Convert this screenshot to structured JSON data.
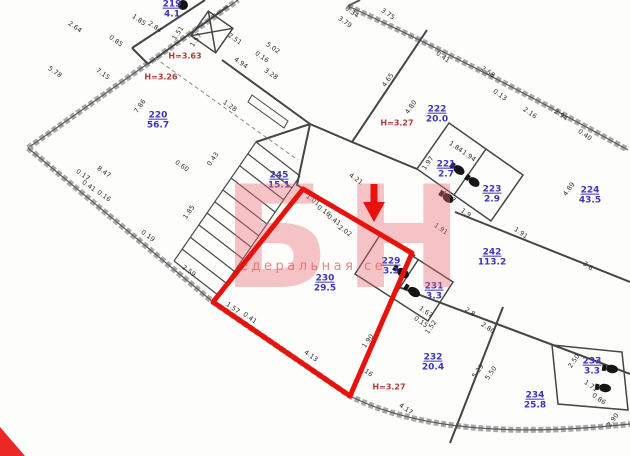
{
  "watermark": {
    "big": "БН",
    "small": "едеральная се"
  },
  "highlight_color": "#e8120c",
  "rooms": [
    {
      "num": "219",
      "area": "4.1",
      "x": 172,
      "y": 10
    },
    {
      "num": "220",
      "area": "56.7",
      "x": 158,
      "y": 121
    },
    {
      "num": "222",
      "area": "20.0",
      "x": 437,
      "y": 115
    },
    {
      "num": "221",
      "area": "2.7",
      "x": 446,
      "y": 170
    },
    {
      "num": "223",
      "area": "2.9",
      "x": 492,
      "y": 195
    },
    {
      "num": "224",
      "area": "43.5",
      "x": 590,
      "y": 196
    },
    {
      "num": "242",
      "area": "113.2",
      "x": 492,
      "y": 258
    },
    {
      "num": "245",
      "area": "15.1",
      "x": 279,
      "y": 181
    },
    {
      "num": "230",
      "area": "29.5",
      "x": 325,
      "y": 284
    },
    {
      "num": "229",
      "area": "3.3",
      "x": 391,
      "y": 267
    },
    {
      "num": "231",
      "area": "3.3",
      "x": 434,
      "y": 292
    },
    {
      "num": "232",
      "area": "20.4",
      "x": 433,
      "y": 363
    },
    {
      "num": "233",
      "area": "3.3",
      "x": 592,
      "y": 367
    },
    {
      "num": "234",
      "area": "25.8",
      "x": 535,
      "y": 401
    }
  ],
  "heights": [
    {
      "t": "Н=3.63",
      "x": 185,
      "y": 56
    },
    {
      "t": "Н=3.26",
      "x": 161,
      "y": 77
    },
    {
      "t": "Н=3.27",
      "x": 397,
      "y": 123
    },
    {
      "t": "Н=3.27",
      "x": 389,
      "y": 387
    }
  ],
  "dimensions": [
    {
      "t": "2.64",
      "x": 75,
      "y": 27,
      "r": 35
    },
    {
      "t": "1.85",
      "x": 139,
      "y": 20,
      "r": 35
    },
    {
      "t": "2.84",
      "x": 155,
      "y": 27,
      "r": 35
    },
    {
      "t": "1.51",
      "x": 178,
      "y": 33,
      "r": -55
    },
    {
      "t": "1.57",
      "x": 196,
      "y": 40,
      "r": -55
    },
    {
      "t": "0.85",
      "x": 116,
      "y": 41,
      "r": 35
    },
    {
      "t": "7.15",
      "x": 103,
      "y": 74,
      "r": 35
    },
    {
      "t": "5.78",
      "x": 55,
      "y": 72,
      "r": 35
    },
    {
      "t": "7.86",
      "x": 140,
      "y": 106,
      "r": -55
    },
    {
      "t": "2.51",
      "x": 235,
      "y": 39,
      "r": 35
    },
    {
      "t": "5.02",
      "x": 273,
      "y": 48,
      "r": 35
    },
    {
      "t": "4.94",
      "x": 241,
      "y": 63,
      "r": 35
    },
    {
      "t": "0.16",
      "x": 262,
      "y": 57,
      "r": 35
    },
    {
      "t": "3.28",
      "x": 271,
      "y": 74,
      "r": 35
    },
    {
      "t": "1.28",
      "x": 230,
      "y": 106,
      "r": 35
    },
    {
      "t": "3.79",
      "x": 345,
      "y": 22,
      "r": 35
    },
    {
      "t": "0.34",
      "x": 352,
      "y": 12,
      "r": 35
    },
    {
      "t": "3.75",
      "x": 388,
      "y": 14,
      "r": 35
    },
    {
      "t": "4.65",
      "x": 388,
      "y": 80,
      "r": -55
    },
    {
      "t": "4.80",
      "x": 411,
      "y": 107,
      "r": -55
    },
    {
      "t": "0.41",
      "x": 443,
      "y": 57,
      "r": 35
    },
    {
      "t": "2.58",
      "x": 488,
      "y": 72,
      "r": 35
    },
    {
      "t": "0.13",
      "x": 500,
      "y": 95,
      "r": 35
    },
    {
      "t": "2.16",
      "x": 530,
      "y": 113,
      "r": 35
    },
    {
      "t": "2.94",
      "x": 561,
      "y": 115,
      "r": 35
    },
    {
      "t": "0.40",
      "x": 585,
      "y": 135,
      "r": 35
    },
    {
      "t": "1.84",
      "x": 456,
      "y": 147,
      "r": 35
    },
    {
      "t": "1.94",
      "x": 469,
      "y": 156,
      "r": 35
    },
    {
      "t": "1.97",
      "x": 428,
      "y": 163,
      "r": -55
    },
    {
      "t": "1.77",
      "x": 449,
      "y": 197,
      "r": 35
    },
    {
      "t": "1.9",
      "x": 466,
      "y": 213,
      "r": 35
    },
    {
      "t": "1.91",
      "x": 521,
      "y": 233,
      "r": 35
    },
    {
      "t": "4.89",
      "x": 569,
      "y": 189,
      "r": -55
    },
    {
      "t": "1.91",
      "x": 441,
      "y": 229,
      "r": 35
    },
    {
      "t": "3.6",
      "x": 588,
      "y": 266,
      "r": 35
    },
    {
      "t": "2.8",
      "x": 470,
      "y": 312,
      "r": 35
    },
    {
      "t": "8.47",
      "x": 104,
      "y": 172,
      "r": 35
    },
    {
      "t": "0.17",
      "x": 83,
      "y": 175,
      "r": 35
    },
    {
      "t": "0.41",
      "x": 89,
      "y": 186,
      "r": 35
    },
    {
      "t": "0.16",
      "x": 104,
      "y": 196,
      "r": 35
    },
    {
      "t": "0.60",
      "x": 182,
      "y": 166,
      "r": 35
    },
    {
      "t": "0.43",
      "x": 213,
      "y": 159,
      "r": -55
    },
    {
      "t": "1.85",
      "x": 189,
      "y": 212,
      "r": -55
    },
    {
      "t": "0.19",
      "x": 148,
      "y": 236,
      "r": 35
    },
    {
      "t": "2.59",
      "x": 189,
      "y": 271,
      "r": 35
    },
    {
      "t": "1.01",
      "x": 313,
      "y": 200,
      "r": 35
    },
    {
      "t": "0.16",
      "x": 324,
      "y": 211,
      "r": 35
    },
    {
      "t": "0.41",
      "x": 334,
      "y": 220,
      "r": 35
    },
    {
      "t": "2.02",
      "x": 345,
      "y": 231,
      "r": 35
    },
    {
      "t": "4.21",
      "x": 356,
      "y": 179,
      "r": 35
    },
    {
      "t": "1.57",
      "x": 233,
      "y": 308,
      "r": 35
    },
    {
      "t": "0.41",
      "x": 250,
      "y": 318,
      "r": 35
    },
    {
      "t": "4.13",
      "x": 311,
      "y": 356,
      "r": 35
    },
    {
      "t": "1.90",
      "x": 368,
      "y": 341,
      "r": -55
    },
    {
      "t": "0.16",
      "x": 366,
      "y": 371,
      "r": 35
    },
    {
      "t": "4.17",
      "x": 406,
      "y": 409,
      "r": 35
    },
    {
      "t": "2.80",
      "x": 488,
      "y": 328,
      "r": 35
    },
    {
      "t": "0.15",
      "x": 421,
      "y": 322,
      "r": 35
    },
    {
      "t": "1.67",
      "x": 426,
      "y": 312,
      "r": 35
    },
    {
      "t": "1.52",
      "x": 431,
      "y": 327,
      "r": -55
    },
    {
      "t": "5.29",
      "x": 478,
      "y": 371,
      "r": -55
    },
    {
      "t": "5.50",
      "x": 491,
      "y": 373,
      "r": -55
    },
    {
      "t": "2.50",
      "x": 574,
      "y": 361,
      "r": -55
    },
    {
      "t": "1.71",
      "x": 591,
      "y": 386,
      "r": 35
    },
    {
      "t": "0.86",
      "x": 599,
      "y": 399,
      "r": 35
    },
    {
      "t": "2.90",
      "x": 613,
      "y": 420,
      "r": -55
    }
  ]
}
